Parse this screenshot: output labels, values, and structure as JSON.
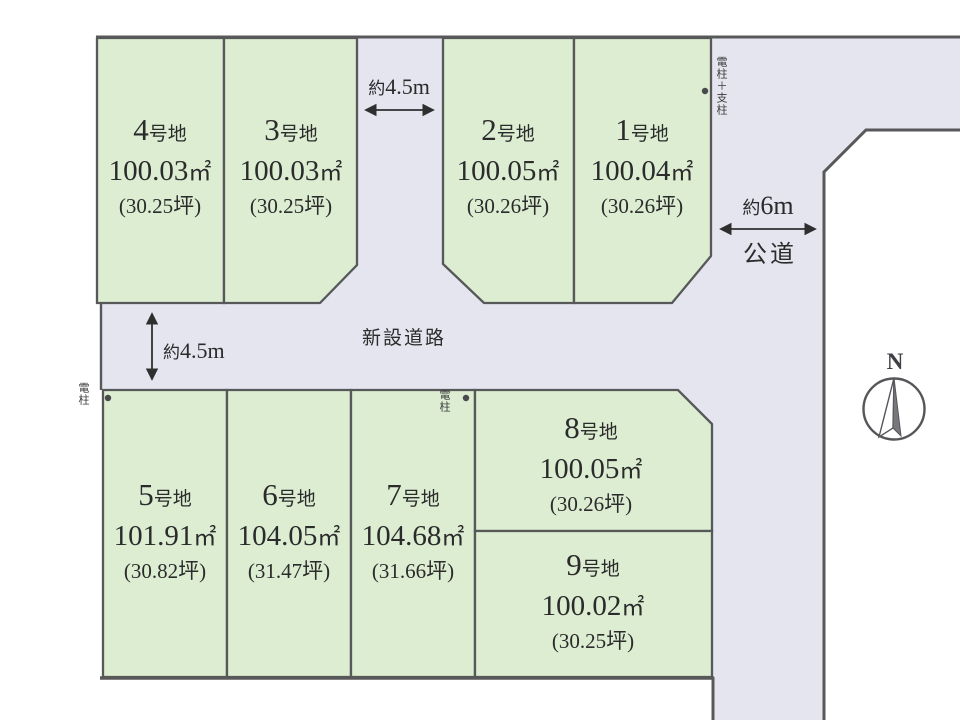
{
  "plots": [
    {
      "num": "1",
      "suffix": "号地",
      "area": "100.04",
      "unit": "㎡",
      "tsubo": "(30.26坪)"
    },
    {
      "num": "2",
      "suffix": "号地",
      "area": "100.05",
      "unit": "㎡",
      "tsubo": "(30.26坪)"
    },
    {
      "num": "3",
      "suffix": "号地",
      "area": "100.03",
      "unit": "㎡",
      "tsubo": "(30.25坪)"
    },
    {
      "num": "4",
      "suffix": "号地",
      "area": "100.03",
      "unit": "㎡",
      "tsubo": "(30.25坪)"
    },
    {
      "num": "5",
      "suffix": "号地",
      "area": "101.91",
      "unit": "㎡",
      "tsubo": "(30.82坪)"
    },
    {
      "num": "6",
      "suffix": "号地",
      "area": "104.05",
      "unit": "㎡",
      "tsubo": "(31.47坪)"
    },
    {
      "num": "7",
      "suffix": "号地",
      "area": "104.68",
      "unit": "㎡",
      "tsubo": "(31.66坪)"
    },
    {
      "num": "8",
      "suffix": "号地",
      "area": "100.05",
      "unit": "㎡",
      "tsubo": "(30.26坪)"
    },
    {
      "num": "9",
      "suffix": "号地",
      "area": "100.02",
      "unit": "㎡",
      "tsubo": "(30.25坪)"
    }
  ],
  "roads": {
    "new_road_label": "新設道路",
    "public_road_label": "公道"
  },
  "dimensions": {
    "top_gap": {
      "prefix": "約",
      "value": "4.5m"
    },
    "left_gap": {
      "prefix": "約",
      "value": "4.5m"
    },
    "public_road": {
      "prefix": "約",
      "value": "6m"
    }
  },
  "poles": {
    "pole_with_support": "電柱＋支柱",
    "pole_left": "電柱",
    "pole_middle": "電柱"
  },
  "compass": {
    "label": "N"
  },
  "colors": {
    "plot_fill": "#dcedd2",
    "road_fill": "#e4e5ee",
    "border": "#58585a",
    "text": "#2b2b2c"
  }
}
